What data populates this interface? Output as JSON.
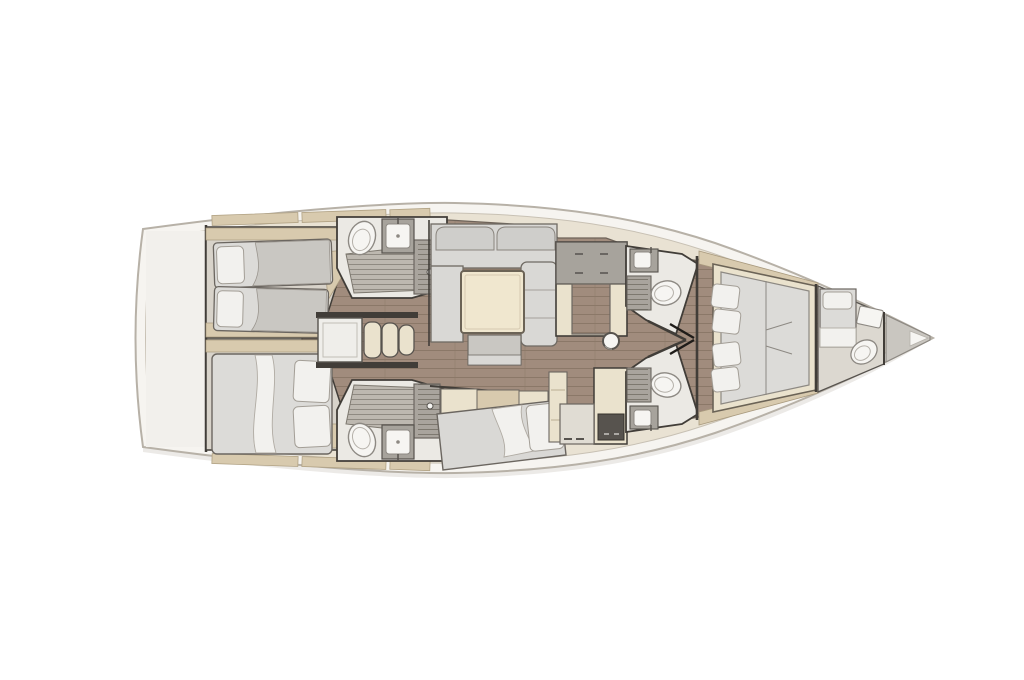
{
  "image": {
    "width": 1024,
    "height": 680
  },
  "colors": {
    "background": "#ffffff",
    "hull_fill": "#f6f4f0",
    "hull_outline": "#b7b1a7",
    "deck_fill": "#e9e2d3",
    "deck_line": "#c8c1b4",
    "transom_fill": "#f2f0ec",
    "deck_trim": "#d8caae",
    "wood_floor": "#a18c7d",
    "plank_line": "#8b7868",
    "cabin_floor": "#d8d3ca",
    "head_floor": "#ebe9e4",
    "grate_fill": "#bdb8b0",
    "grate_line": "#8f8a82",
    "slat_fill": "#a9a49d",
    "slat_line": "#7d786f",
    "furniture_cream": "#eae2cd",
    "table_cream": "#f0e7cf",
    "counter_gray": "#a7a39c",
    "counter_dark": "#57534e",
    "tan_wood": "#d8caae",
    "cushion_gray": "#cfcecb",
    "seat_gray": "#d9d8d5",
    "mattress_gray": "#dcdbd8",
    "blanket_gray": "#c9c7c2",
    "bedding_white": "#f2f1ee",
    "fixture_white": "#f6f5f2",
    "fixture_line": "#8d8983",
    "wall_dark": "#413d38",
    "locker_gray": "#c9c6c0"
  },
  "features": [
    "hull",
    "transom-garage",
    "side-deck-lockers",
    "aft-port-cabin-twin-beds",
    "aft-starboard-cabin-double-bed",
    "aft-port-head",
    "aft-starboard-head",
    "companionway-steps",
    "salon-u-sofa",
    "salon-table",
    "salon-ottoman",
    "starboard-settee-daybed",
    "port-galley-unit",
    "starboard-galley-nav-unit",
    "mast-post",
    "forward-port-head",
    "forward-starboard-head",
    "master-cabin-double-bed",
    "crew-cabin",
    "bow-sail-locker"
  ]
}
